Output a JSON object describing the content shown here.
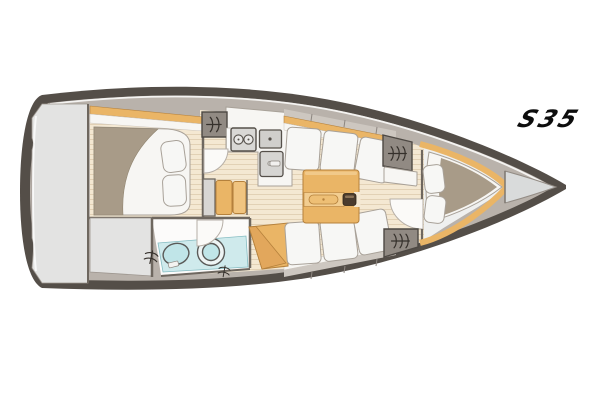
{
  "page": {
    "background": "#ffffff"
  },
  "logo": {
    "text": "S35"
  },
  "palette": {
    "page_bg": "#ffffff",
    "hull": "#544e48",
    "deck": "#b9b2ab",
    "deck_light": "#cdc7c0",
    "stern_panel": "#e3e3e2",
    "wall": "#6e675f",
    "wood": "#eab566",
    "wood_dark": "#b5813c",
    "wood_light": "#f2cd90",
    "floor": "#f4e8d2",
    "floor_stripe": "#e2d1b5",
    "white_furniture": "#f7f6f3",
    "furniture_stroke": "#a8a198",
    "cushion": "#f7f7f5",
    "mattress": "#a89b88",
    "locker": "#918a83",
    "locker_stroke": "#4d4843",
    "appliance": "#d9d8d5",
    "appliance_stroke": "#55504a",
    "wet_area": "#cfeaec",
    "fixture": "#c0e5e8",
    "fixture_stroke": "#5a5a58",
    "bow_locker": "#d9dbdb",
    "louver": "#35302b",
    "highlight": "#f4f3f1",
    "logo": "#0d0d0d",
    "table_knob": "#4a3b2d"
  },
  "plan": {
    "type": "sailboat-interior-floor-plan",
    "regions": [
      "stern-platform",
      "aft-cabin",
      "aft-storage",
      "head",
      "galley",
      "companionway-steps",
      "salon",
      "forward-cabin",
      "bow-locker"
    ]
  }
}
